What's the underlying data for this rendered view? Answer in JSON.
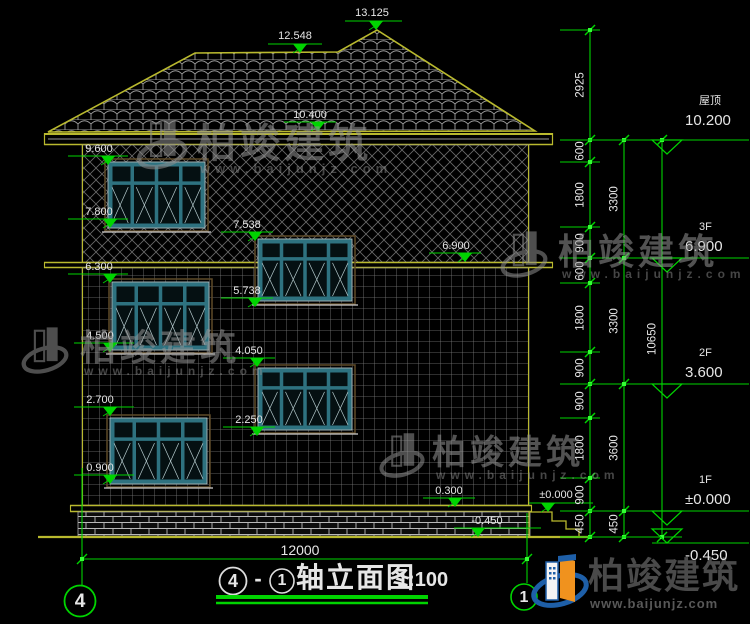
{
  "drawing": {
    "title": {
      "axis_from": "4",
      "separator": "-",
      "axis_to": "1",
      "name": "轴立面图",
      "scale": "1:100"
    },
    "overall_width_dim": "12000",
    "axis_bubble_left": "4",
    "axis_bubble_right": "1"
  },
  "right_panel": {
    "levels": [
      {
        "floor": "屋顶",
        "value": "10.200"
      },
      {
        "floor": "3F",
        "value": "6.900"
      },
      {
        "floor": "2F",
        "value": "3.600"
      },
      {
        "floor": "1F",
        "value": "±0.000"
      },
      {
        "floor": "",
        "value": "-0.450"
      }
    ],
    "chain_inner": [
      "2925",
      "600",
      "1800",
      "900",
      "600",
      "1800",
      "900",
      "900",
      "1800",
      "900",
      "450"
    ],
    "chain_mid": [
      "3300",
      "3300",
      "3600",
      "450"
    ],
    "chain_total": [
      "10650"
    ]
  },
  "elevation_marks": [
    "13.125",
    "12.548",
    "10.400",
    "9.600",
    "7.800",
    "7.538",
    "6.900",
    "6.300",
    "5.738",
    "4.500",
    "4.050",
    "2.700",
    "2.250",
    "0.900",
    "0.300",
    "±0.000",
    "-0.450"
  ],
  "watermark": {
    "brand": "柏竣建筑",
    "site": "www.baijunjz.com"
  },
  "logo": {
    "brand": "柏竣建筑",
    "site": "www.baijunjz.com"
  },
  "colors": {
    "dim_green": "#00d400",
    "cad_yellow": "#b9b92e",
    "window_teal": "#2e7280",
    "logo_blue": "#1e5fa8",
    "logo_orange": "#f0921e"
  }
}
